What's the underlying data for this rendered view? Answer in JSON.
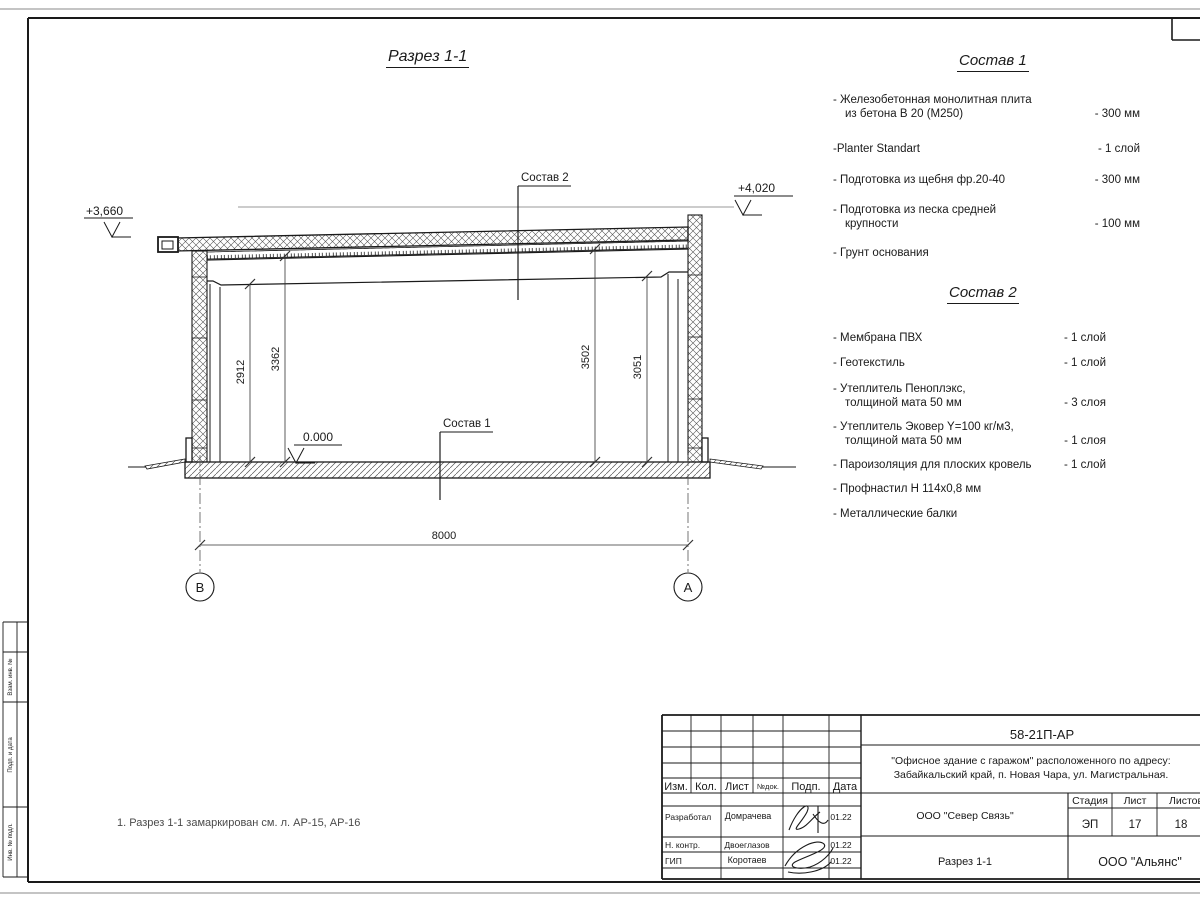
{
  "page": {
    "note": "1. Разрез 1-1 замаркирован см. л. АР-15, АР-16"
  },
  "drawing": {
    "title": "Разрез 1-1",
    "elevations": {
      "left": "+3,660",
      "right": "+4,020",
      "zero": "0.000"
    },
    "leaders": {
      "sostav1": "Состав 1",
      "sostav2": "Состав 2"
    },
    "dimensions": {
      "d2912": "2912",
      "d3362": "3362",
      "d3502": "3502",
      "d3051": "3051",
      "span": "8000"
    },
    "axes": {
      "left": "В",
      "right": "А"
    }
  },
  "compositions": [
    {
      "title": "Состав 1",
      "items": [
        {
          "line1": "- Железобетонная  монолитная плита",
          "line2": "из бетона В 20 (М250)",
          "value": "- 300 мм"
        },
        {
          "line1": "-Planter Standart",
          "line2": "",
          "value": "- 1 слой"
        },
        {
          "line1": "- Подготовка из щебня фр.20-40",
          "line2": "",
          "value": "- 300 мм"
        },
        {
          "line1": "- Подготовка из песка средней",
          "line2": "крупности",
          "value": "- 100 мм"
        },
        {
          "line1": "- Грунт основания",
          "line2": "",
          "value": ""
        }
      ]
    },
    {
      "title": "Состав 2",
      "items": [
        {
          "line1": "- Мембрана ПВХ",
          "line2": "",
          "value": "- 1 слой"
        },
        {
          "line1": "- Геотекстиль",
          "line2": "",
          "value": "- 1 слой"
        },
        {
          "line1": "- Утеплитель Пеноплэкс,",
          "line2": "толщиной мата 50 мм",
          "value": "- 3  слоя"
        },
        {
          "line1": "- Утеплитель Эковер Y=100 кг/м3,",
          "line2": "толщиной мата 50 мм",
          "value": "- 1 слоя"
        },
        {
          "line1": "- Пароизоляция для плоских кровель",
          "line2": "",
          "value": "- 1 слой"
        },
        {
          "line1": "- Профнастил Н 114х0,8 мм",
          "line2": "",
          "value": ""
        },
        {
          "line1": "- Металлические балки",
          "line2": "",
          "value": ""
        }
      ]
    }
  ],
  "titleblock": {
    "doc_number": "58-21П-АР",
    "project_line1": "\"Офисное здание с гаражом\" расположенного по адресу:",
    "project_line2": "Забайкальский край, п. Новая Чара, ул. Магистральная.",
    "header_cols": [
      "Изм.",
      "Кол.",
      "Лист",
      "№док.",
      "Подп.",
      "Дата"
    ],
    "rows": [
      {
        "role": "Разработал",
        "name": "Домрачева",
        "date": "01.22"
      },
      {
        "role": "Н. контр.",
        "name": "Двоеглазов",
        "date": "01.22"
      },
      {
        "role": "ГИП",
        "name": "Коротаев",
        "date": "01.22"
      }
    ],
    "company": "ООО \"Север Связь\"",
    "sheet_title": "Разрез 1-1",
    "org": "ООО \"Альянс\"",
    "stage_label": "Стадия",
    "sheet_label": "Лист",
    "sheets_label": "Листов",
    "stage": "ЭП",
    "sheet": "17",
    "sheets": "18"
  },
  "side_stamp": {
    "labels": [
      "Взам. инв. №",
      "Подп. и дата",
      "Инв. № подл."
    ]
  },
  "colors": {
    "ink": "#1a1a1a",
    "hatch": "#555555",
    "edge": "#b0b0b0",
    "muted": "#999999"
  }
}
